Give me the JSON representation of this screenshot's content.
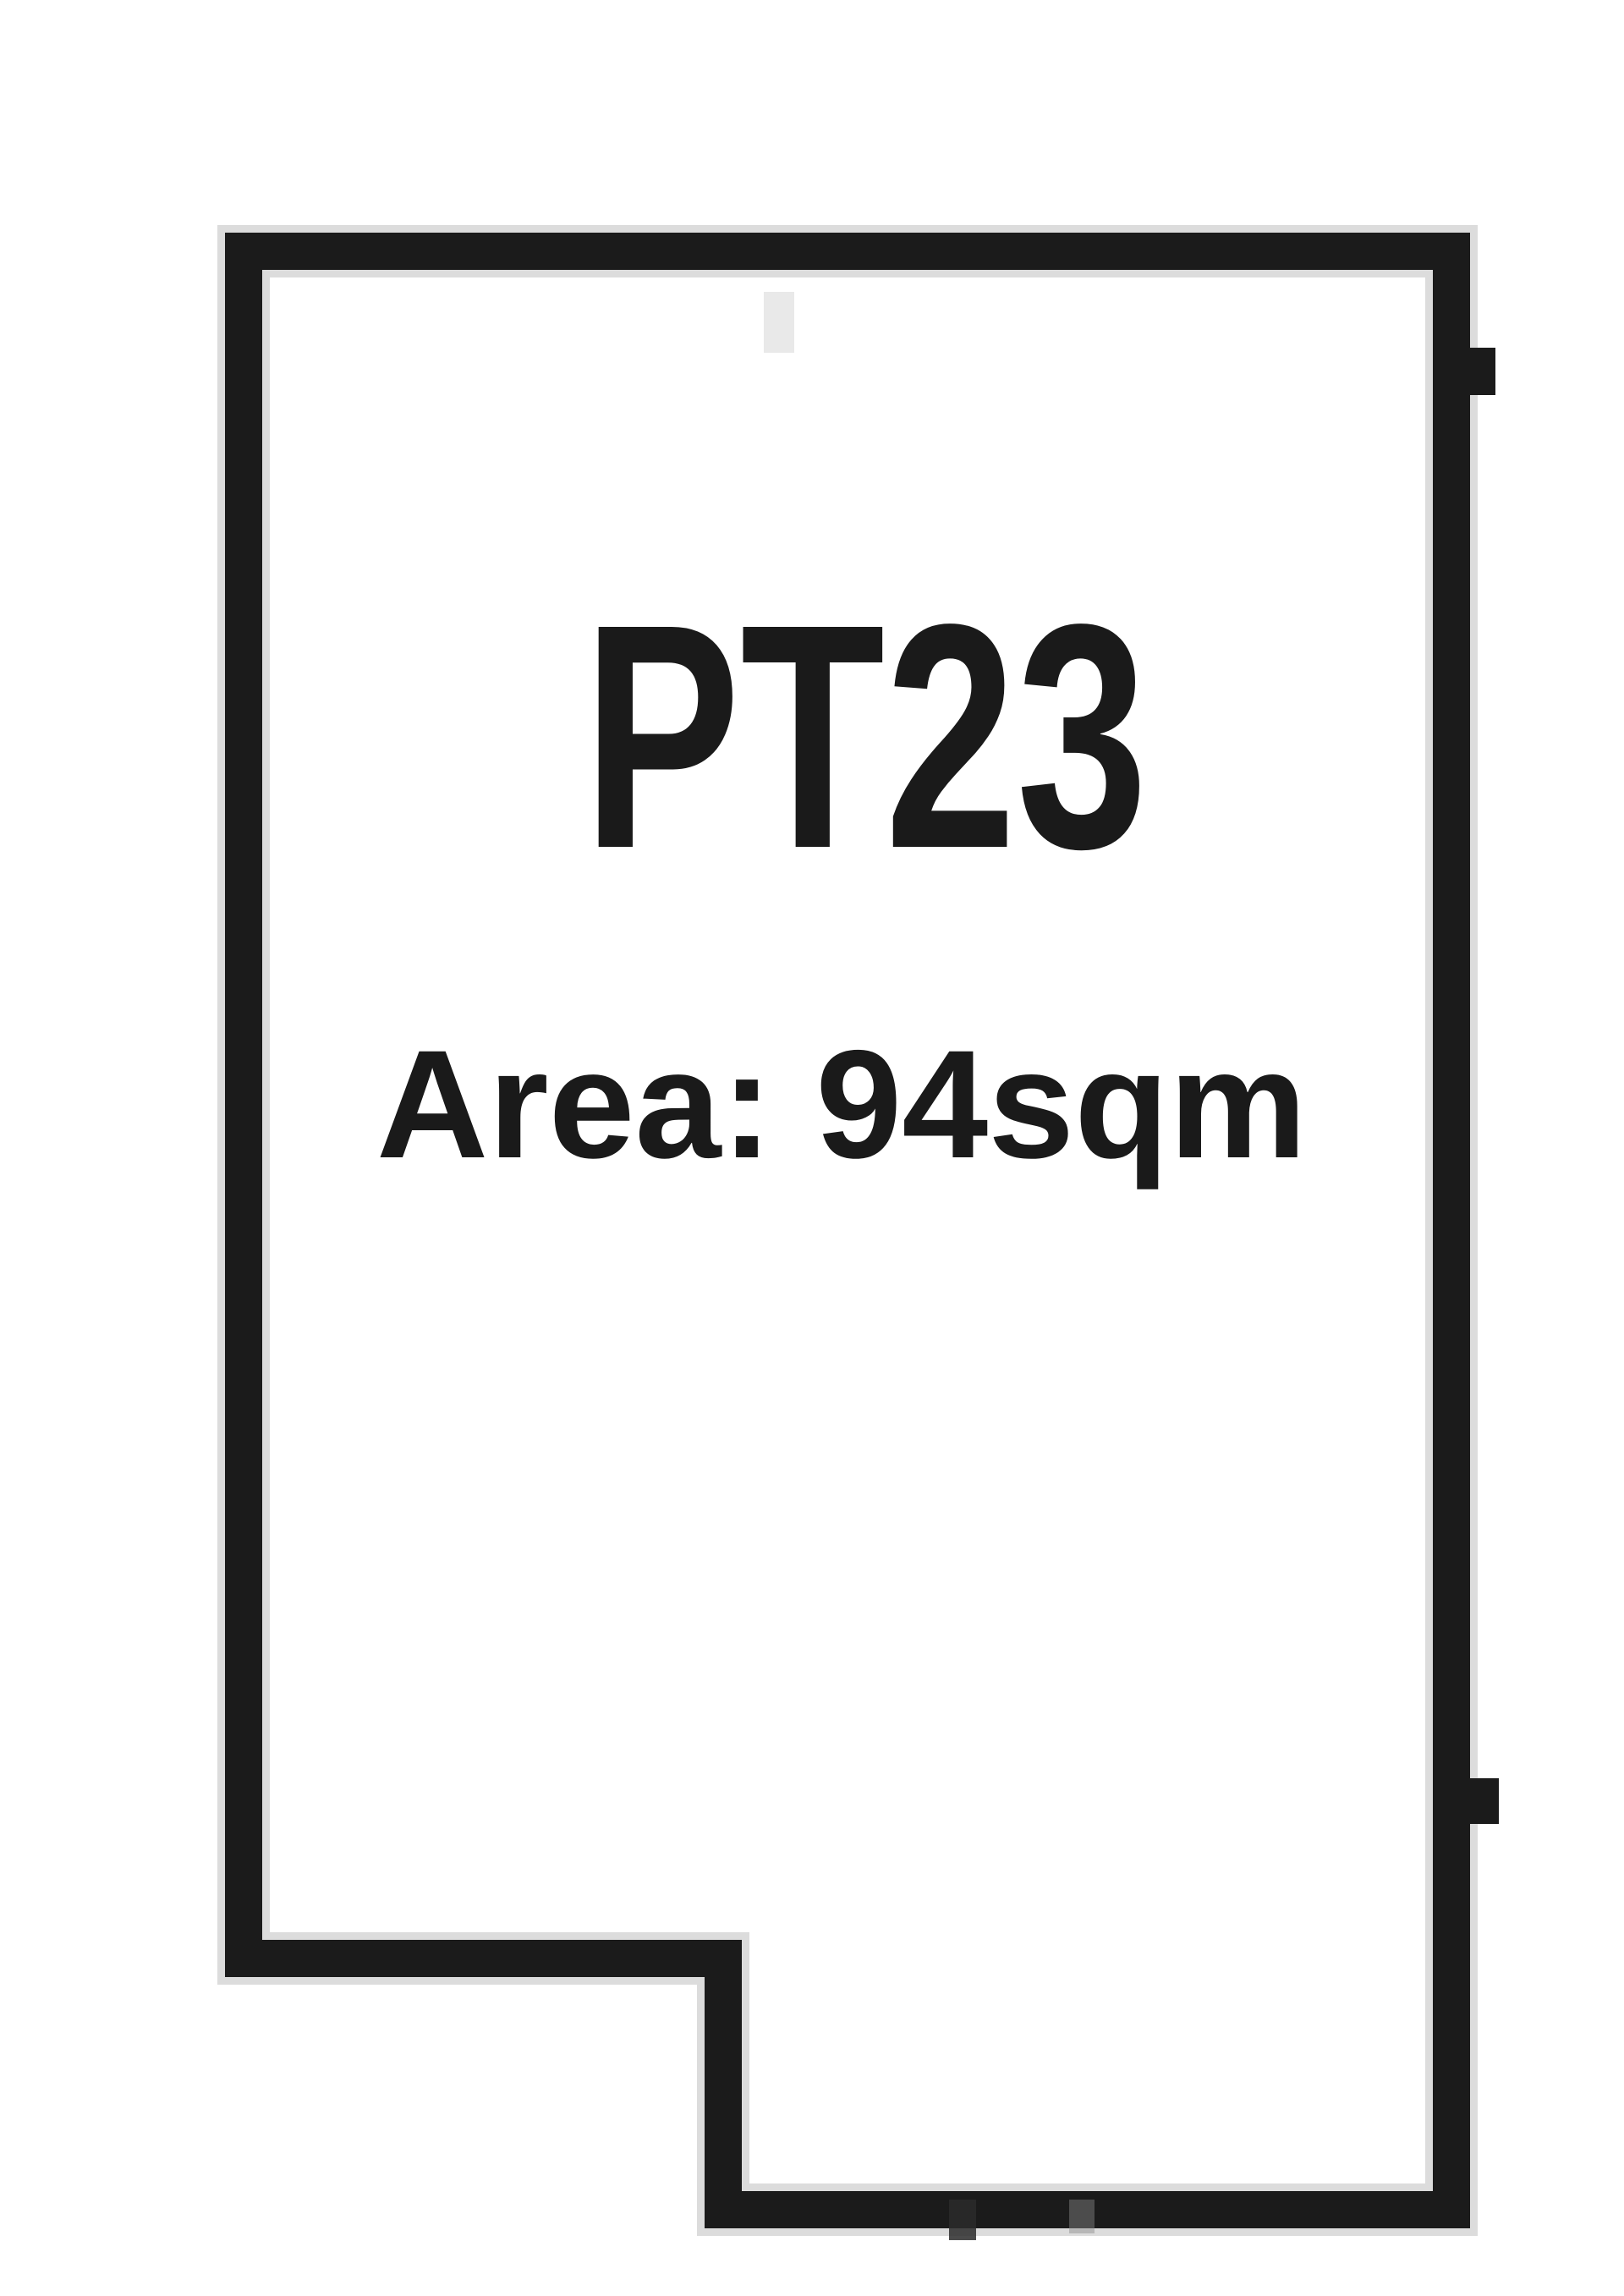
{
  "parcel": {
    "id": "PT23",
    "area_text": "Area: 94sqm"
  },
  "colors": {
    "background": "#ffffff",
    "outline": "#1b1b1b",
    "text": "#1a1a1a"
  }
}
